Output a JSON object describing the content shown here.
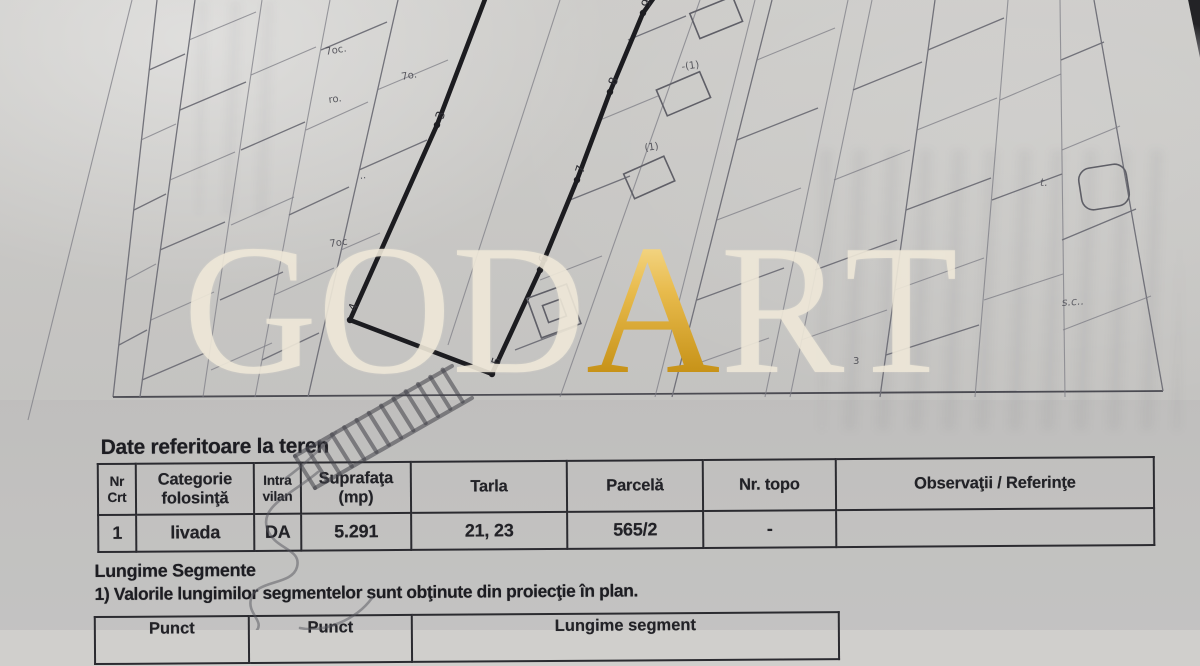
{
  "paper": {
    "base_color": "#d0cfcc",
    "ink_color": "#212126",
    "map_line_color": "#72727a"
  },
  "watermark": {
    "text": "GODART",
    "letters": [
      "G",
      "O",
      "D",
      "A",
      "R",
      "T"
    ],
    "gold_letter_index": 3,
    "cream_color": "#eee7d8",
    "gold_color": "#d9a62e"
  },
  "map": {
    "point_labels": [
      "3",
      "4",
      "5",
      "6",
      "7",
      "8",
      "9"
    ],
    "scribbles": [
      "7oc.",
      "7o.",
      "ro.",
      "..",
      "7oc",
      "-(1)",
      "(1)",
      "3",
      "s.c..",
      "t."
    ]
  },
  "teren": {
    "title": "Date referitoare la teren",
    "table": {
      "headers": [
        "Nr\nCrt",
        "Categorie\nfolosinţă",
        "Intra\nvilan",
        "Suprafaţa\n(mp)",
        "Tarla",
        "Parcelă",
        "Nr. topo",
        "Observaţii / Referinţe"
      ],
      "rows": [
        [
          "1",
          "livada",
          "DA",
          "5.291",
          "21, 23",
          "565/2",
          "-",
          ""
        ]
      ]
    }
  },
  "segmente": {
    "heading": "Lungime Segmente",
    "note": "1) Valorile lungimilor segmentelor sunt obţinute din proiecţie în plan.",
    "table_headers": [
      "Punct",
      "Punct",
      "Lungime segment"
    ]
  }
}
